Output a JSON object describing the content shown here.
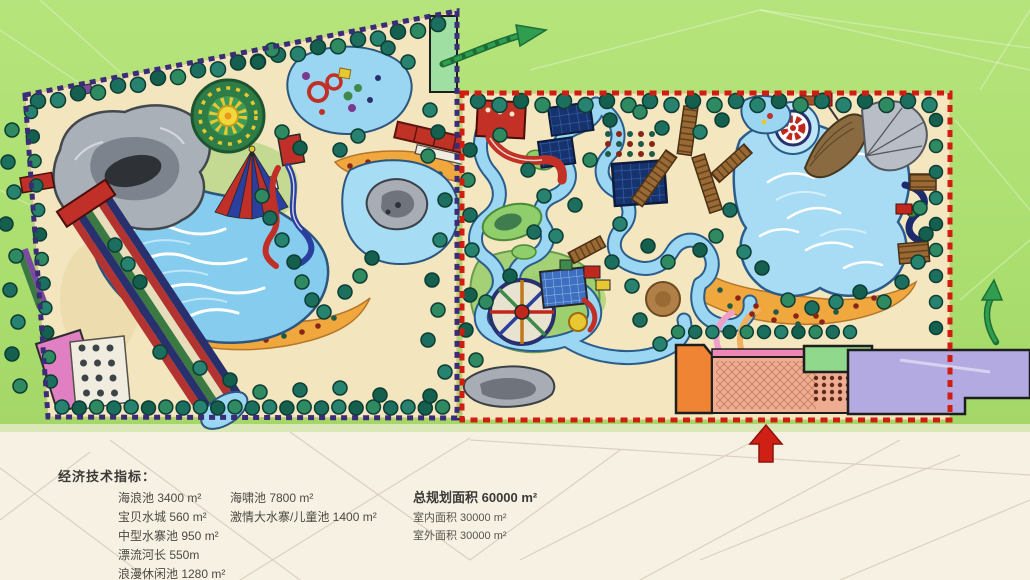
{
  "legend": {
    "heading": "经济技术指标：",
    "pools_column1": [
      "海浪池 3400 m²",
      "宝贝水城 560 m²",
      "中型水寨池  950 m²",
      "漂流河长  550m",
      "浪漫休闲池  1280 m²"
    ],
    "pools_column2": [
      "海啸池  7800 m²",
      "激情大水寨/儿童池  1400 m²"
    ],
    "summary_total": "总规划面积 60000 m²",
    "summary_indoor": "室内面积 30000 m²",
    "summary_outdoor": "室外面积 30000 m²"
  },
  "map": {
    "features": [
      "rock-mountain",
      "wave-pool",
      "sun-wheel",
      "circus-tent",
      "kids-water-city",
      "leisure-pool",
      "racing-slides",
      "pink-building",
      "terrace-plaza",
      "red-train-station",
      "lazy-river",
      "tsunami-pool",
      "pirate-ship",
      "life-ring",
      "kids-water-fort",
      "tower-slide",
      "entrance-plaza",
      "indoor-hall",
      "green-hall",
      "orange-hall"
    ],
    "colors": {
      "background_green": "#aede71",
      "background_paper": "#f7f1e4",
      "park_sand": "#f3e5bd",
      "water": "#8fd2f0",
      "deep_pool": "#16336e",
      "tree": "#1c6f5f",
      "left_boundary": "#3b2c78",
      "right_boundary": "#d11c12",
      "beach": "#f0a83e",
      "arrow_green": "#2f9e4f",
      "arrow_red": "#cf2016"
    }
  }
}
